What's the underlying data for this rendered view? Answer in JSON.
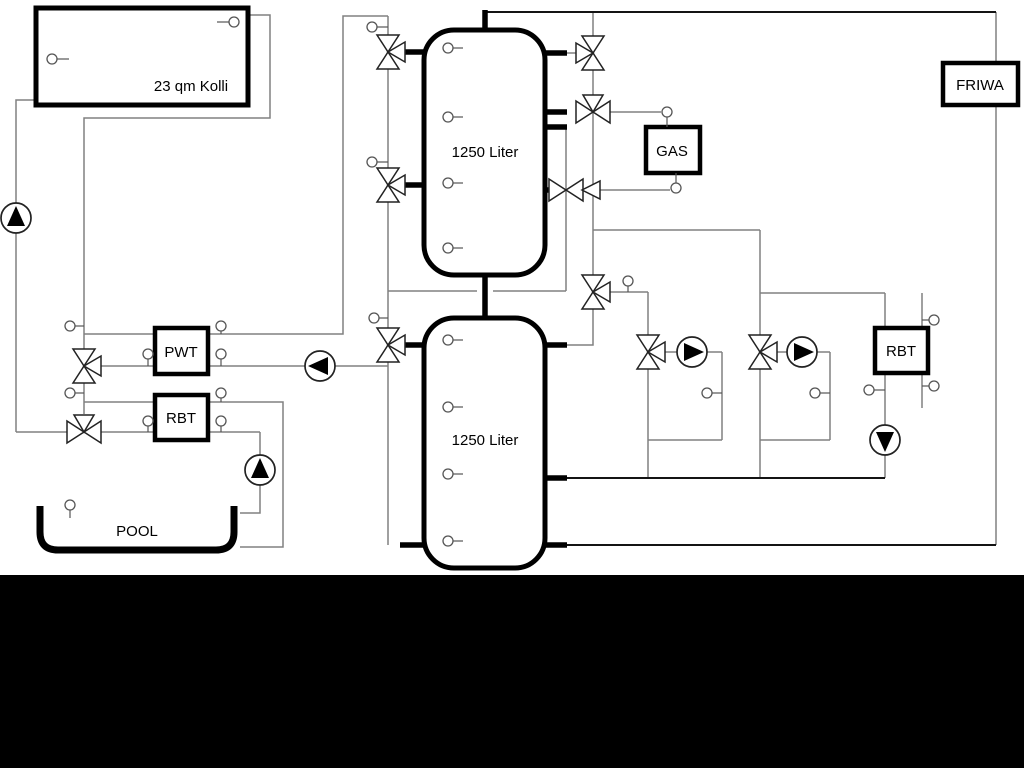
{
  "diagram": {
    "background_color": "#ffffff",
    "bottom_bar_color": "#000000",
    "line_colors": {
      "primary_black": "#141414",
      "secondary_gray": "#808080"
    },
    "labels": {
      "collector": "23 qm Kolli",
      "buffer_tank_upper": "1250 Liter",
      "buffer_tank_lower": "1250 Liter",
      "gas_boiler": "GAS",
      "friwa": "FRIWA",
      "pwt": "PWT",
      "rbt_left": "RBT",
      "rbt_right": "RBT",
      "pool": "POOL"
    },
    "components": {
      "pumps": [
        {
          "id": "solar-pump",
          "flow_direction": "up"
        },
        {
          "id": "pwt-primary-pump",
          "flow_direction": "left"
        },
        {
          "id": "pool-pump",
          "flow_direction": "up"
        },
        {
          "id": "heating-circuit-1-pump",
          "flow_direction": "right"
        },
        {
          "id": "heating-circuit-2-pump",
          "flow_direction": "right"
        },
        {
          "id": "rbt-right-pump",
          "flow_direction": "down"
        }
      ],
      "three_way_valve_count": 11,
      "temperature_sensor_count": 30
    }
  }
}
